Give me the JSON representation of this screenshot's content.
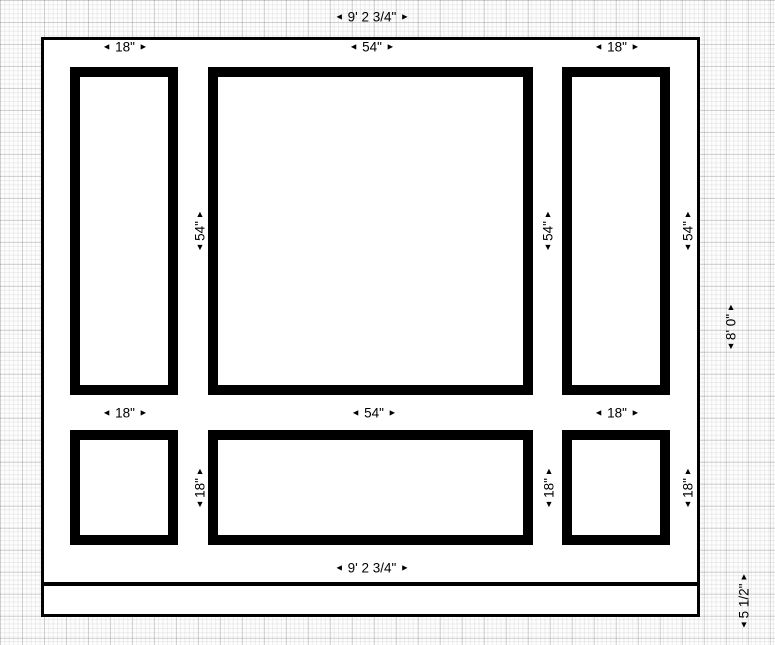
{
  "arrows": {
    "left": "◄",
    "right": "►",
    "up": "▲",
    "down": "▼"
  },
  "colors": {
    "line": "#000000",
    "paper": "#ffffff",
    "grid_minor": "#ededed",
    "grid_major": "#d6d6d6"
  },
  "dimensions": {
    "overall_width_top": "9' 2 3/4\"",
    "overall_width_bottom": "9' 2 3/4\"",
    "overall_height": "8' 0\"",
    "baseboard_height": "5 1/2\"",
    "top_row": {
      "width_labels": [
        "18\"",
        "54\"",
        "18\""
      ],
      "height_labels": [
        "54\"",
        "54\"",
        "54\""
      ]
    },
    "bottom_row": {
      "width_labels": [
        "18\"",
        "54\"",
        "18\""
      ],
      "height_labels": [
        "18\"",
        "18\"",
        "18\""
      ]
    }
  }
}
